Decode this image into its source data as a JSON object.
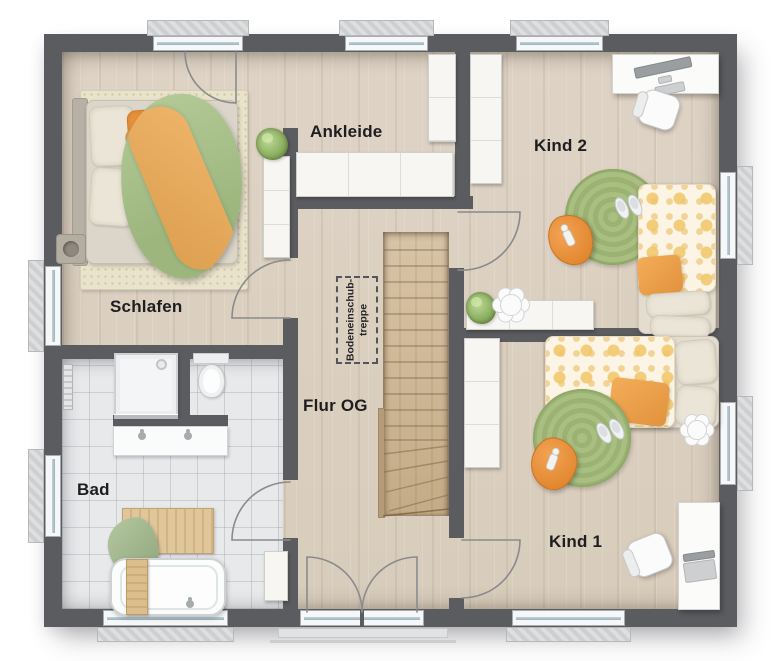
{
  "plan": {
    "rooms": [
      {
        "id": "schlafen",
        "label": "Schlafen"
      },
      {
        "id": "ankleide",
        "label": "Ankleide"
      },
      {
        "id": "kind2",
        "label": "Kind 2"
      },
      {
        "id": "bad",
        "label": "Bad"
      },
      {
        "id": "flur",
        "label": "Flur OG"
      },
      {
        "id": "kind1",
        "label": "Kind 1"
      }
    ],
    "annotations": {
      "attic_ladder_line1": "Bodeneinschub-",
      "attic_ladder_line2": "treppe"
    },
    "colors": {
      "wall": "#5b5c60",
      "wood": "#dcd1c2",
      "tile": "#e8e9eb",
      "stair": "#ccb593",
      "green": "#a6bd80",
      "orange": "#e8913d",
      "duvetGreen": "#a9c08c",
      "bandOrange": "#e2a55c",
      "label": "#1e1e20"
    },
    "furniture": {
      "schlafen": [
        "double-bed",
        "rug",
        "pillows",
        "green-duvet",
        "orange-blanket",
        "pouf",
        "dresser",
        "plant"
      ],
      "ankleide": [
        "wardrobe-long",
        "wardrobe-column"
      ],
      "kind2": [
        "wardrobe",
        "desk",
        "monitor",
        "office-chair",
        "round-rug",
        "beanbag",
        "doll",
        "slippers",
        "single-bed",
        "flower-table",
        "sideboard",
        "plant"
      ],
      "bad": [
        "shower",
        "toilet",
        "double-vanity",
        "radiator",
        "wood-mat",
        "towel",
        "bathtub",
        "caddy",
        "cabinet"
      ],
      "flur": [
        "staircase",
        "attic-hatch",
        "french-door"
      ],
      "kind1": [
        "wardrobe",
        "single-bed",
        "flower-table",
        "round-rug",
        "beanbag",
        "doll",
        "slippers",
        "desk",
        "laptop",
        "office-chair"
      ]
    }
  }
}
